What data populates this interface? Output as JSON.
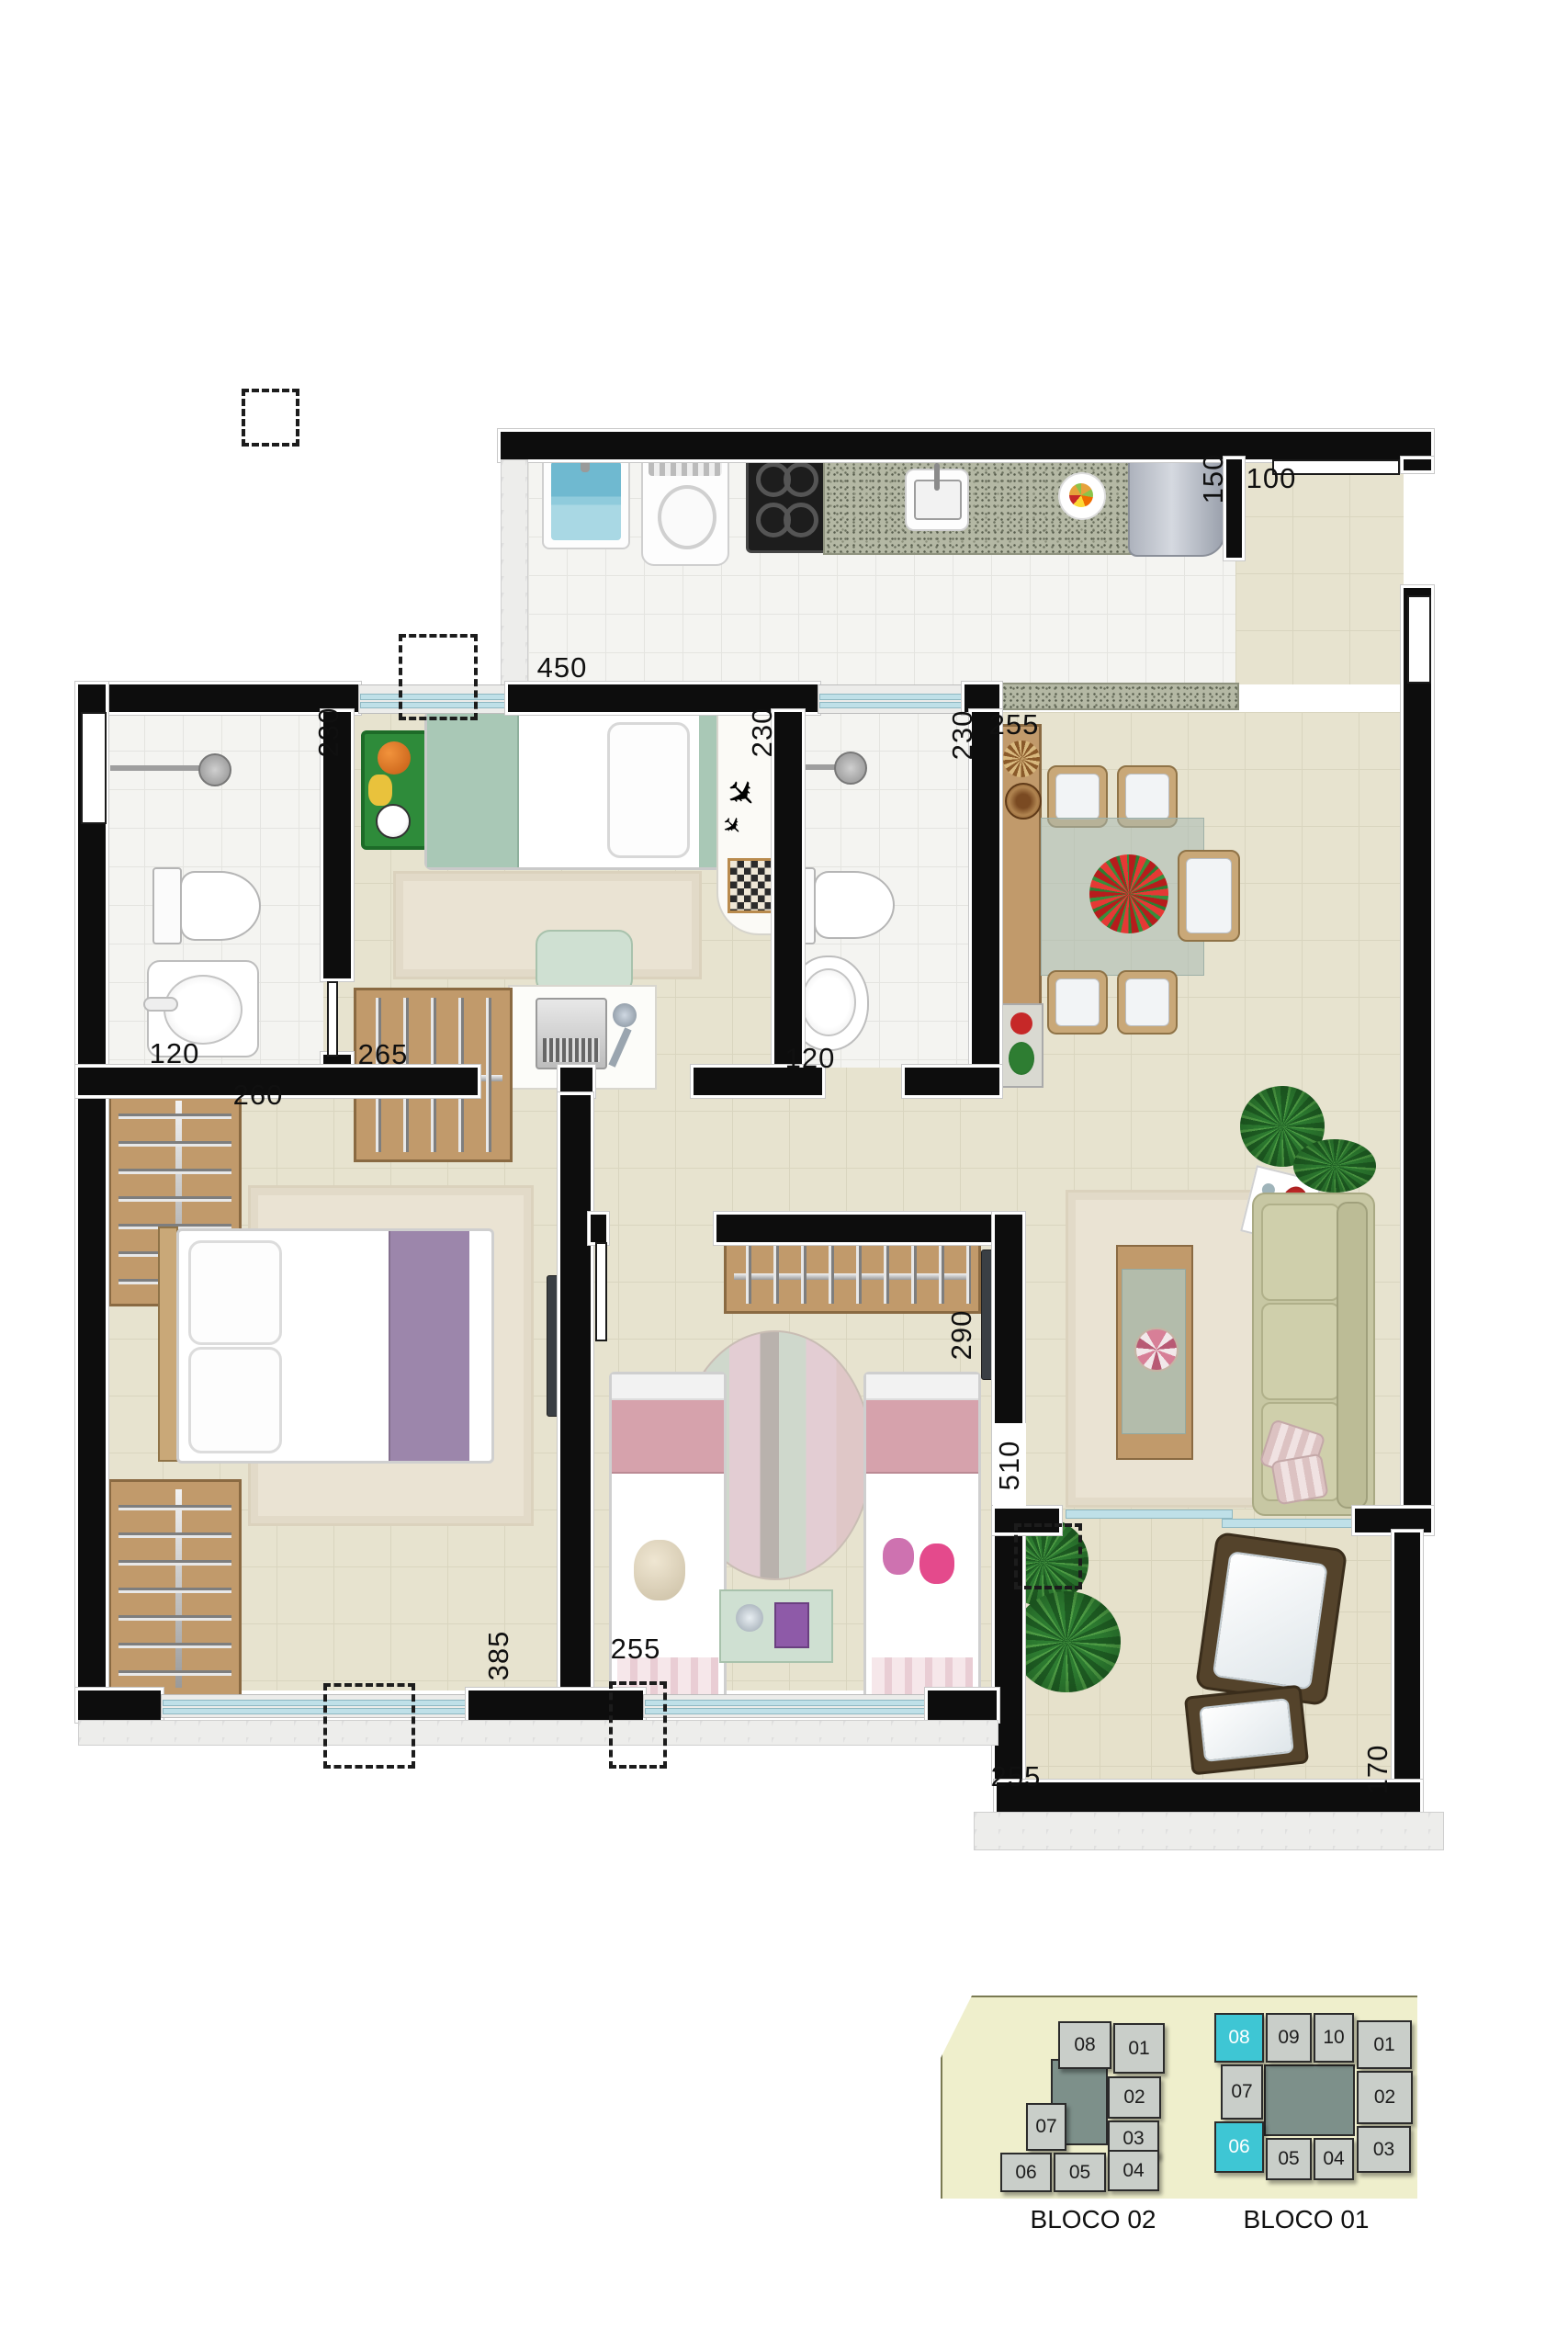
{
  "colors": {
    "highlight": "#3EC6D4",
    "wall": "#0D0D0D",
    "floor_beige": "#E7E3CF",
    "floor_tile": "#F4F4F1",
    "wood": "#C19A6B",
    "keyplan_bg": "#EFEFCC",
    "keyplan_unit": "#C9CEC9",
    "keyplan_core": "#7D908A",
    "window_glass": "#BFE0E8"
  },
  "plan": {
    "dims": {
      "kitchen_450": "450",
      "nook_150": "150",
      "hall_100": "100",
      "bath1_230": "230",
      "bath1_120": "120",
      "kids_230": "230",
      "kids_265": "265",
      "bath2_230": "230",
      "bath2_120": "120",
      "dining_255": "255",
      "master_260": "260",
      "master_385": "385",
      "girls_290": "290",
      "girls_255": "255",
      "living_510": "510",
      "balcony_255": "255",
      "balcony_170": "170"
    }
  },
  "keyplan": {
    "blocks": [
      {
        "label": "BLOCO 02",
        "units": [
          {
            "n": "08"
          },
          {
            "n": "01"
          },
          {
            "n": "02"
          },
          {
            "n": "03"
          },
          {
            "n": "07"
          },
          {
            "n": "06"
          },
          {
            "n": "05"
          },
          {
            "n": "04"
          }
        ]
      },
      {
        "label": "BLOCO 01",
        "units": [
          {
            "n": "08",
            "hl": true
          },
          {
            "n": "09"
          },
          {
            "n": "10"
          },
          {
            "n": "01"
          },
          {
            "n": "07"
          },
          {
            "n": "02"
          },
          {
            "n": "06",
            "hl": true
          },
          {
            "n": "05"
          },
          {
            "n": "04"
          },
          {
            "n": "03"
          }
        ]
      }
    ]
  }
}
